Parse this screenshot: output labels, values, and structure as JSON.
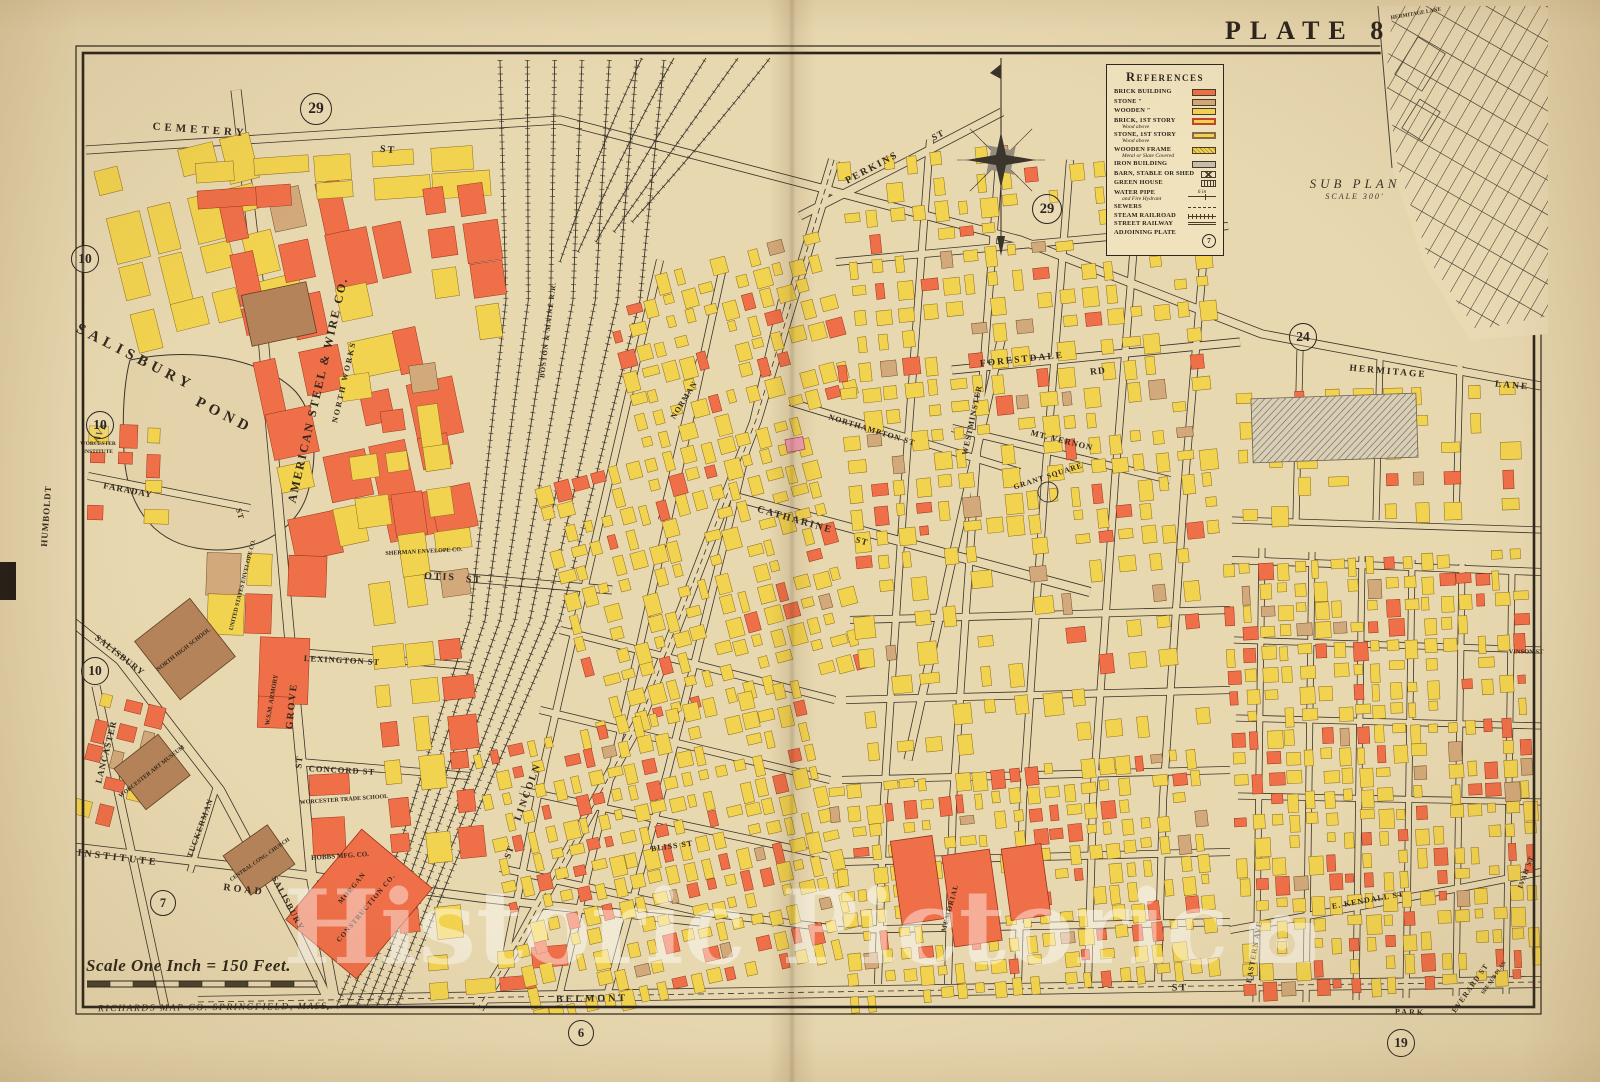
{
  "page": {
    "plate_label": "Plate",
    "plate_number": "8",
    "scale_text": "Scale One Inch = 150 Feet.",
    "publisher": "RICHARDS MAP CO. SPRINGFIELD, MASS."
  },
  "legend": {
    "title": "References",
    "items": [
      {
        "label": "Brick Building",
        "swatch": "brick"
      },
      {
        "label": "Stone ″",
        "swatch": "stone"
      },
      {
        "label": "Wooden ″",
        "swatch": "wood"
      },
      {
        "label": "Brick, 1st Story",
        "sub": "Wood above",
        "swatch": "brick1"
      },
      {
        "label": "Stone, 1st Story",
        "sub": "Wood above",
        "swatch": "stone1"
      },
      {
        "label": "Wooden Frame",
        "sub": "Metal or Slate Covered",
        "swatch": "frame"
      },
      {
        "label": "Iron Building",
        "swatch": "iron"
      },
      {
        "label": "Barn, Stable or Shed",
        "swatch": "barn"
      },
      {
        "label": "Green House",
        "swatch": "green"
      },
      {
        "label": "Water Pipe",
        "sub": "and Fire Hydrant",
        "swatch": "water",
        "swatch_text": "6 in"
      },
      {
        "label": "Sewers",
        "swatch": "sewer"
      },
      {
        "label": "Steam Railroad",
        "swatch": "railroad"
      },
      {
        "label": "Street Railway",
        "swatch": "railway"
      },
      {
        "label": "Adjoining Plate",
        "swatch": "plate",
        "swatch_text": "7"
      }
    ]
  },
  "subplan": {
    "title": "SUB PLAN",
    "scale": "SCALE 300'"
  },
  "watermark": {
    "text": "Historic Pictoric"
  },
  "plate_refs": [
    {
      "n": "29",
      "x": 315,
      "y": 108,
      "s": 30
    },
    {
      "n": "10",
      "x": 84,
      "y": 258,
      "s": 26
    },
    {
      "n": "10",
      "x": 99,
      "y": 424,
      "s": 26
    },
    {
      "n": "10",
      "x": 94,
      "y": 670,
      "s": 26
    },
    {
      "n": "7",
      "x": 162,
      "y": 902,
      "s": 24
    },
    {
      "n": "29",
      "x": 1046,
      "y": 208,
      "s": 28
    },
    {
      "n": "24",
      "x": 1302,
      "y": 336,
      "s": 26
    },
    {
      "n": "6",
      "x": 580,
      "y": 1032,
      "s": 24
    },
    {
      "n": "19",
      "x": 1400,
      "y": 1042,
      "s": 26
    }
  ],
  "labels": [
    {
      "t": "CEMETERY",
      "x": 200,
      "y": 130,
      "r": 4,
      "s": 11,
      "ls": 4
    },
    {
      "t": "ST",
      "x": 388,
      "y": 150,
      "r": 5,
      "s": 10,
      "ls": 2
    },
    {
      "t": "SALISBURY",
      "x": 135,
      "y": 358,
      "r": 27,
      "s": 15,
      "ls": 5
    },
    {
      "t": "POND",
      "x": 224,
      "y": 416,
      "r": 27,
      "s": 15,
      "ls": 5
    },
    {
      "t": "AMERICAN STEEL & WIRE CO.",
      "x": 318,
      "y": 390,
      "r": -77,
      "s": 12,
      "ls": 2
    },
    {
      "t": "NORTH WORKS",
      "x": 344,
      "y": 382,
      "r": -77,
      "s": 8,
      "ls": 2
    },
    {
      "t": "HUMBOLDT",
      "x": 46,
      "y": 516,
      "r": -86,
      "s": 9,
      "ls": 1
    },
    {
      "t": "AVE",
      "x": 100,
      "y": 432,
      "r": -62,
      "s": 9,
      "ls": 1
    },
    {
      "t": "FARADAY",
      "x": 128,
      "y": 490,
      "r": 11,
      "s": 9,
      "ls": 1
    },
    {
      "t": "ST",
      "x": 240,
      "y": 514,
      "r": 75,
      "s": 8,
      "ls": 1
    },
    {
      "t": "WORCESTER",
      "x": 98,
      "y": 444,
      "r": 0,
      "s": 5.5,
      "ls": 0
    },
    {
      "t": "INSTITUTE",
      "x": 98,
      "y": 452,
      "r": 0,
      "s": 5.5,
      "ls": 0
    },
    {
      "t": "GROVE",
      "x": 292,
      "y": 706,
      "r": -84,
      "s": 10,
      "ls": 2
    },
    {
      "t": "ST",
      "x": 299,
      "y": 762,
      "r": -84,
      "s": 9,
      "ls": 1
    },
    {
      "t": "SALISBURY",
      "x": 120,
      "y": 655,
      "r": 38,
      "s": 9,
      "ls": 1
    },
    {
      "t": "SALISBURY",
      "x": 288,
      "y": 903,
      "r": 62,
      "s": 9,
      "ls": 1
    },
    {
      "t": "LANCASTER",
      "x": 106,
      "y": 752,
      "r": -76,
      "s": 9,
      "ls": 1
    },
    {
      "t": "INSTITUTE",
      "x": 118,
      "y": 858,
      "r": 7,
      "s": 10,
      "ls": 3
    },
    {
      "t": "ROAD",
      "x": 244,
      "y": 890,
      "r": 7,
      "s": 10,
      "ls": 3
    },
    {
      "t": "TUCKERMAN",
      "x": 200,
      "y": 828,
      "r": -70,
      "s": 8,
      "ls": 1
    },
    {
      "t": "LEXINGTON ST",
      "x": 342,
      "y": 660,
      "r": 3,
      "s": 8.5,
      "ls": 1
    },
    {
      "t": "CONCORD ST",
      "x": 342,
      "y": 770,
      "r": 3,
      "s": 8.5,
      "ls": 1
    },
    {
      "t": "OTIS",
      "x": 440,
      "y": 577,
      "r": 3,
      "s": 10,
      "ls": 2
    },
    {
      "t": "ST",
      "x": 474,
      "y": 580,
      "r": 3,
      "s": 10,
      "ls": 2
    },
    {
      "t": "NORTH HIGH SCHOOL",
      "x": 184,
      "y": 650,
      "r": -38,
      "s": 6,
      "ls": 0
    },
    {
      "t": "WORCESTER ART MUSEUM",
      "x": 152,
      "y": 772,
      "r": -38,
      "s": 6,
      "ls": 0
    },
    {
      "t": "CENTRAL CONG. CHURCH",
      "x": 260,
      "y": 860,
      "r": -35,
      "s": 5.5,
      "ls": 0
    },
    {
      "t": "W.S.M. ARMORY",
      "x": 272,
      "y": 700,
      "r": -80,
      "s": 6.5,
      "ls": 0
    },
    {
      "t": "WORCESTER TRADE SCHOOL",
      "x": 344,
      "y": 800,
      "r": -4,
      "s": 6,
      "ls": 0
    },
    {
      "t": "HOBBS MFG. CO.",
      "x": 340,
      "y": 856,
      "r": -4,
      "s": 7,
      "ls": 0
    },
    {
      "t": "UNITED STATES ENVELOPE CO.",
      "x": 243,
      "y": 585,
      "r": -76,
      "s": 6,
      "ls": 0
    },
    {
      "t": "SHERMAN ENVELOPE CO.",
      "x": 424,
      "y": 552,
      "r": -3,
      "s": 6,
      "ls": 0
    },
    {
      "t": "MORGAN",
      "x": 352,
      "y": 888,
      "r": -50,
      "s": 7,
      "ls": 1
    },
    {
      "t": "CONSTRUCTION CO.",
      "x": 366,
      "y": 908,
      "r": -50,
      "s": 7,
      "ls": 1
    },
    {
      "t": "BOSTON & MAINE R.R.",
      "x": 548,
      "y": 330,
      "r": -83,
      "s": 7,
      "ls": 1
    },
    {
      "t": "LINCOLN",
      "x": 528,
      "y": 792,
      "r": -70,
      "s": 10,
      "ls": 2
    },
    {
      "t": "ST",
      "x": 509,
      "y": 852,
      "r": -70,
      "s": 9,
      "ls": 1
    },
    {
      "t": "BELMONT",
      "x": 592,
      "y": 999,
      "r": -1,
      "s": 10,
      "ls": 3
    },
    {
      "t": "ST",
      "x": 1180,
      "y": 988,
      "r": -1,
      "s": 10,
      "ls": 2
    },
    {
      "t": "PERKINS",
      "x": 872,
      "y": 168,
      "r": -28,
      "s": 10,
      "ls": 2
    },
    {
      "t": "ST",
      "x": 938,
      "y": 135,
      "r": -28,
      "s": 9,
      "ls": 1
    },
    {
      "t": "FORESTDALE",
      "x": 1022,
      "y": 360,
      "r": -6,
      "s": 9.5,
      "ls": 2
    },
    {
      "t": "RD",
      "x": 1098,
      "y": 372,
      "r": -6,
      "s": 9.5,
      "ls": 1
    },
    {
      "t": "HERMITAGE",
      "x": 1388,
      "y": 372,
      "r": 5,
      "s": 9.5,
      "ls": 2
    },
    {
      "t": "LANE",
      "x": 1512,
      "y": 386,
      "r": 5,
      "s": 9.5,
      "ls": 2
    },
    {
      "t": "MT. VERNON",
      "x": 1062,
      "y": 440,
      "r": 14,
      "s": 8.5,
      "ls": 1
    },
    {
      "t": "NORTHAMPTON ST",
      "x": 872,
      "y": 430,
      "r": 17,
      "s": 8,
      "ls": 1
    },
    {
      "t": "CATHARINE",
      "x": 795,
      "y": 520,
      "r": 16,
      "s": 10,
      "ls": 2
    },
    {
      "t": "ST",
      "x": 862,
      "y": 541,
      "r": 16,
      "s": 9,
      "ls": 1
    },
    {
      "t": "NORMAN",
      "x": 684,
      "y": 400,
      "r": -58,
      "s": 8,
      "ls": 1
    },
    {
      "t": "WESTMINSTER",
      "x": 972,
      "y": 420,
      "r": -78,
      "s": 8,
      "ls": 1
    },
    {
      "t": "GRANT SQUARE",
      "x": 1048,
      "y": 476,
      "r": -18,
      "s": 7.5,
      "ls": 1
    },
    {
      "t": "MEMORIAL",
      "x": 950,
      "y": 908,
      "r": -75,
      "s": 7,
      "ls": 1
    },
    {
      "t": "BLISS ST",
      "x": 672,
      "y": 846,
      "r": -8,
      "s": 8,
      "ls": 1
    },
    {
      "t": "E. KENDALL ST",
      "x": 1368,
      "y": 900,
      "r": -10,
      "s": 8,
      "ls": 1
    },
    {
      "t": "EASTERN AVE",
      "x": 1254,
      "y": 952,
      "r": -80,
      "s": 7.5,
      "ls": 1
    },
    {
      "t": "EVERARD ST",
      "x": 1470,
      "y": 988,
      "r": -55,
      "s": 7.5,
      "ls": 1
    },
    {
      "t": "SEE SUB PLAN",
      "x": 1494,
      "y": 978,
      "r": -55,
      "s": 5.5,
      "ls": 0
    },
    {
      "t": "PARK",
      "x": 1410,
      "y": 1012,
      "r": 2,
      "s": 8,
      "ls": 2
    },
    {
      "t": "VINSON ST",
      "x": 1526,
      "y": 652,
      "r": 0,
      "s": 6.5,
      "ls": 0
    },
    {
      "t": "IVAH ST",
      "x": 1526,
      "y": 872,
      "r": -70,
      "s": 7,
      "ls": 1
    },
    {
      "t": "HERMITAGE LANE",
      "x": 1416,
      "y": 14,
      "r": -10,
      "s": 5.5,
      "ls": 0
    }
  ],
  "colors": {
    "paper": "#e8d8b0",
    "ink": "#3a332a",
    "brick": "#ef6f48",
    "wood": "#f2d34f",
    "stone": "#d2a97a",
    "special": "#b5835a",
    "iron": "#c6beac"
  }
}
